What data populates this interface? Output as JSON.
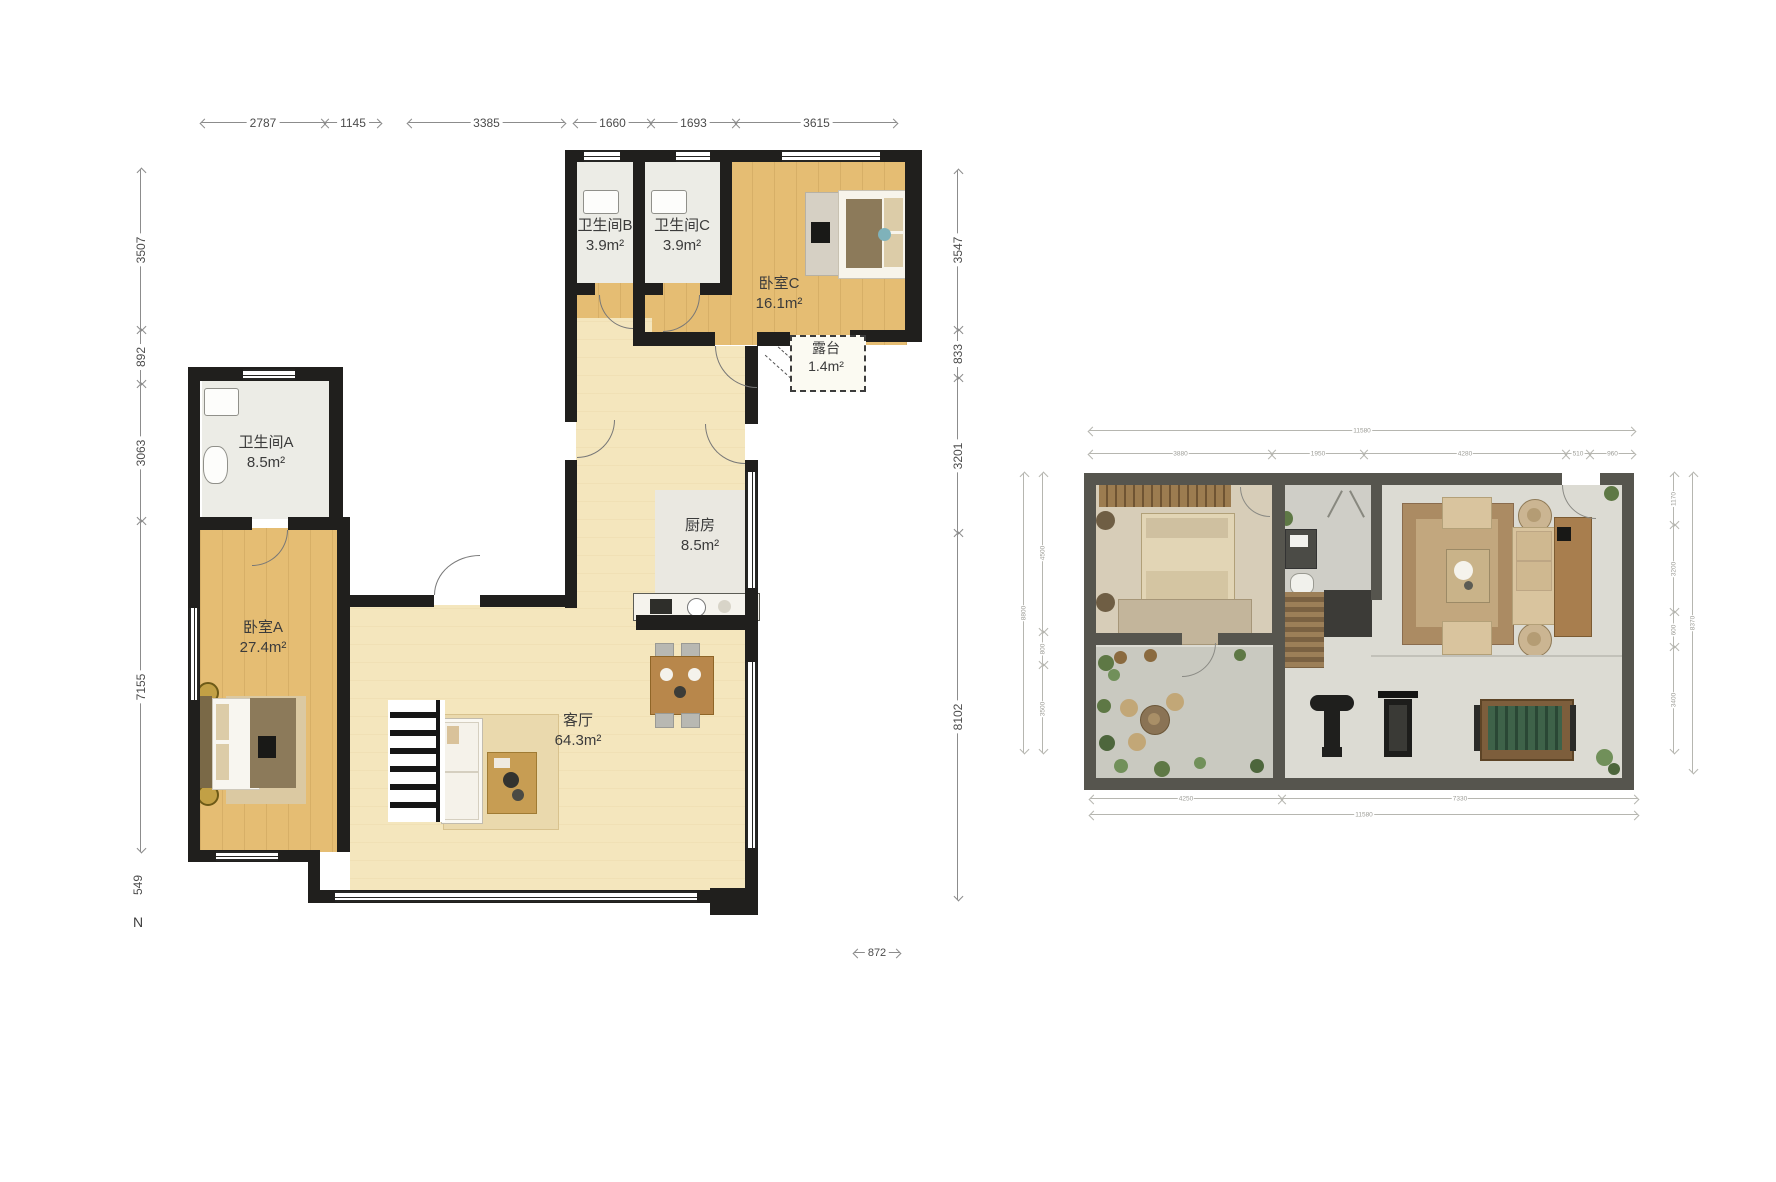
{
  "page": {
    "background": "#ffffff"
  },
  "left_plan": {
    "compass": "N",
    "dims_top": [
      "2787",
      "1145",
      "3385",
      "1660",
      "1693",
      "3615"
    ],
    "dims_left": [
      "3507",
      "892",
      "3063",
      "7155",
      "549"
    ],
    "dims_right": [
      "3547",
      "833",
      "3201",
      "8102"
    ],
    "dim_bottom": "872",
    "rooms": {
      "bath_b": {
        "name": "卫生间B",
        "area": "3.9m²"
      },
      "bath_c": {
        "name": "卫生间C",
        "area": "3.9m²"
      },
      "bed_c": {
        "name": "卧室C",
        "area": "16.1m²"
      },
      "terrace": {
        "name": "露台",
        "area": "1.4m²"
      },
      "bath_a": {
        "name": "卫生间A",
        "area": "8.5m²"
      },
      "kitchen": {
        "name": "厨房",
        "area": "8.5m²"
      },
      "bed_a": {
        "name": "卧室A",
        "area": "27.4m²"
      },
      "living": {
        "name": "客厅",
        "area": "64.3m²"
      }
    }
  },
  "right_plan": {
    "dims_top": {
      "total": "11580",
      "segments": [
        "3880",
        "1950",
        "4280",
        "510",
        "960"
      ]
    },
    "dims_bottom": {
      "total": "11580",
      "segments": [
        "4250",
        "7330"
      ]
    },
    "dims_left": {
      "total": "8800",
      "segments": [
        "4500",
        "800",
        "3500"
      ]
    },
    "dims_right": {
      "total": "8370",
      "segments": [
        "1170",
        "3200",
        "600",
        "3400"
      ]
    }
  },
  "colors": {
    "wall": "#201f1d",
    "wood_floor": "#e5bd73",
    "cream_floor": "#f4e6bd",
    "bath_floor": "#ecece6",
    "right_plan_wall": "#56554e",
    "plant_green": "#5e7845"
  }
}
